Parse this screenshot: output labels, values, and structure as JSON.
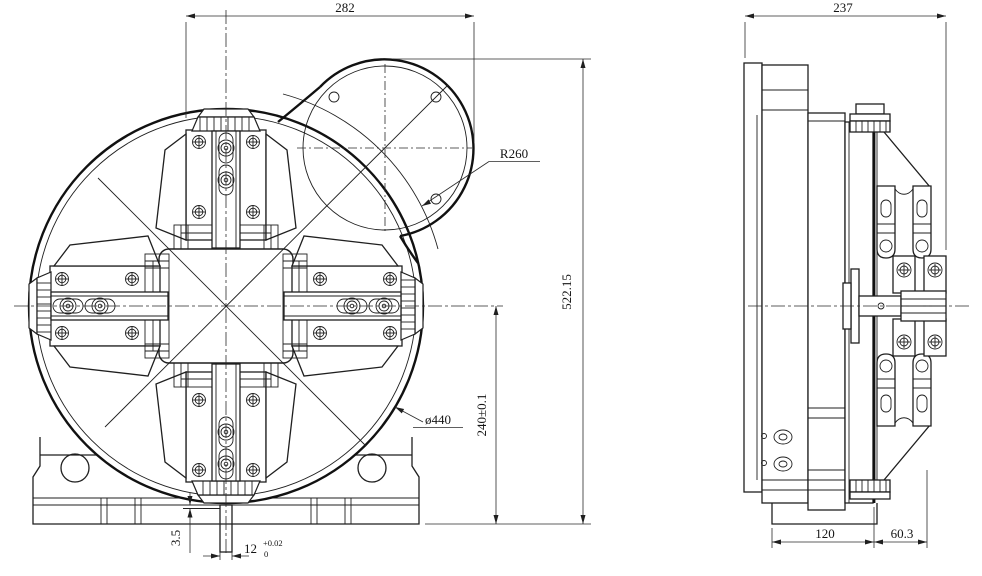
{
  "drawing": {
    "front_view": {
      "dims": {
        "d282": "282",
        "r260": "R260",
        "d522": "522.15",
        "d440": "ø440",
        "d240": "240±0.1",
        "d35": "3.5",
        "d12": "12",
        "d12_tol_upper": "+0.02",
        "d12_tol_lower": "0"
      }
    },
    "side_view": {
      "dims": {
        "d237": "237",
        "d120": "120",
        "d603": "60.3"
      }
    },
    "colors": {
      "line": "#1f1f1f",
      "background": "#ffffff"
    }
  }
}
